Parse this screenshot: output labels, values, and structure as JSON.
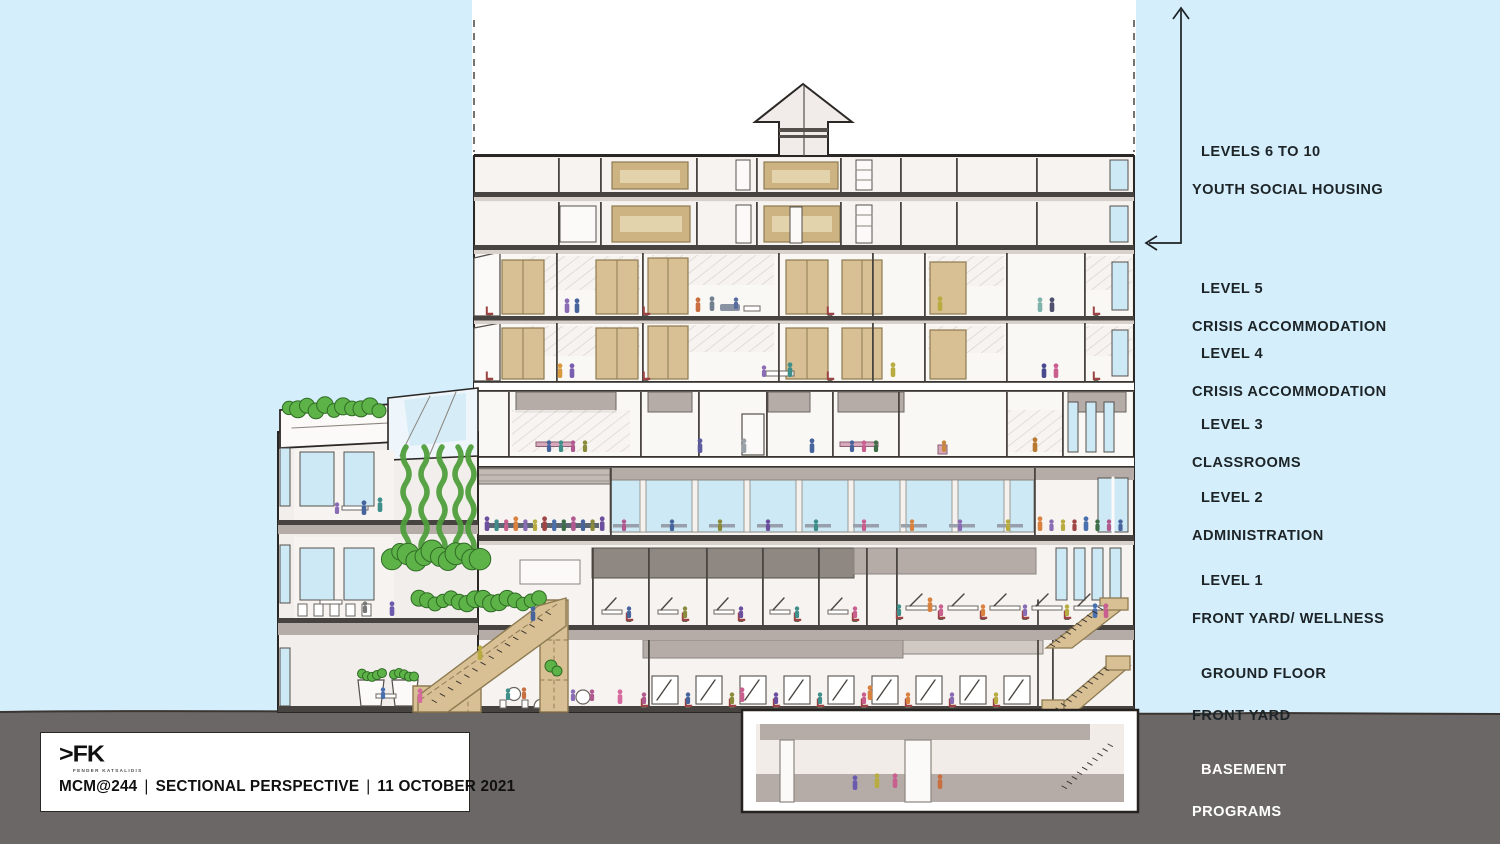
{
  "level_labels": [
    {
      "id": "levels-6-10",
      "title": "LEVELS 6 TO 10",
      "subtitle": "YOUTH SOCIAL HOUSING"
    },
    {
      "id": "level-5",
      "title": "LEVEL 5",
      "subtitle": "CRISIS ACCOMMODATION"
    },
    {
      "id": "level-4",
      "title": "LEVEL 4",
      "subtitle": "CRISIS ACCOMMODATION"
    },
    {
      "id": "level-3",
      "title": "LEVEL 3",
      "subtitle": "CLASSROOMS"
    },
    {
      "id": "level-2",
      "title": "LEVEL 2",
      "subtitle": "ADMINISTRATION"
    },
    {
      "id": "level-1",
      "title": "LEVEL 1",
      "subtitle": "FRONT YARD/ WELLNESS"
    },
    {
      "id": "ground-floor",
      "title": "GROUND FLOOR",
      "subtitle": "FRONT YARD"
    },
    {
      "id": "basement",
      "title": "BASEMENT",
      "subtitle": "PROGRAMS"
    }
  ],
  "title_block": {
    "logo_text": ">FK",
    "firm_name": "FENDER KATSALIDIS",
    "project_code": "MCM@244",
    "separator": "|",
    "drawing_title": "SECTIONAL PERSPECTIVE",
    "date": "11 OCTOBER 2021"
  },
  "colors": {
    "sky": "#d4eefb",
    "ground": "#6b6767",
    "wall_white": "#f2eeeb",
    "slab_dark": "#474340",
    "slab_gray": "#b5aca8",
    "timber_tan": "#d9c094",
    "plant_green": "#5eb348",
    "glass_blue": "#cde9f6",
    "label_text": "#1d2427",
    "basement_label_text": "#ffffff",
    "ink": "#2b2724"
  }
}
